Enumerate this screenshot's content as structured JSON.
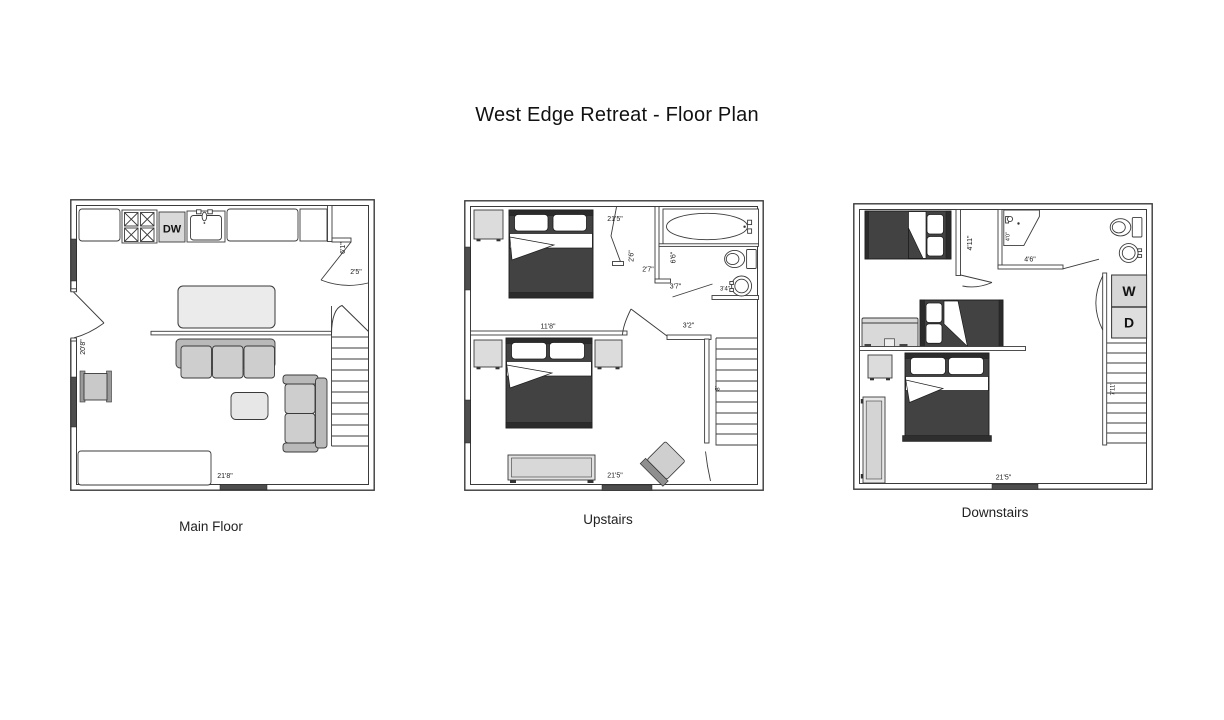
{
  "title": "West Edge Retreat  - Floor Plan",
  "plans": {
    "main": {
      "name": "Main Floor",
      "appliances": {
        "dishwasher": "DW"
      },
      "dims": {
        "closet_height": "6'1\"",
        "closet_width": "2'5\"",
        "left_wall": "20'8\"",
        "bottom_wall": "21'8\""
      }
    },
    "upstairs": {
      "name": "Upstairs",
      "dims": {
        "top_wall": "21'5\"",
        "closet_depth": "2'6\"",
        "closet_width": "2'7\"",
        "bath_height": "6'6\"",
        "bath_entry": "3'7\"",
        "sink_wall": "3'4\"",
        "bedroom_width": "11'8\"",
        "hall_width": "3'2\"",
        "stairs": "8'",
        "bottom_wall": "21'5\""
      }
    },
    "downstairs": {
      "name": "Downstairs",
      "appliances": {
        "washer": "W",
        "dryer": "D"
      },
      "dims": {
        "partition": "4'11\"",
        "shower": "4'0\"",
        "bath_width": "4'6\"",
        "stairs": "7'11\"",
        "bottom_wall": "21'5\""
      }
    }
  }
}
